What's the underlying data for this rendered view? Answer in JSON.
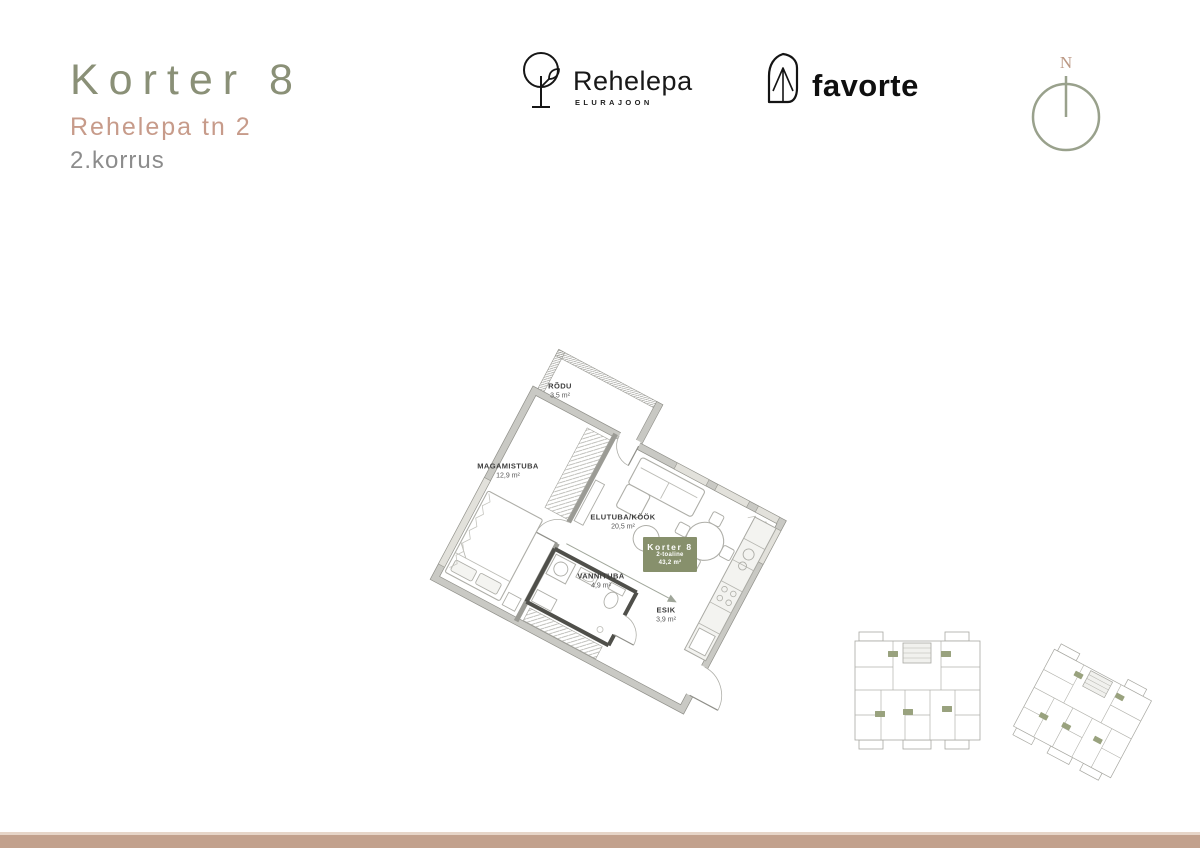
{
  "header": {
    "title": "Korter 8",
    "address": "Rehelepa tn 2",
    "floor": "2.korrus"
  },
  "branding": {
    "rehelepa": {
      "name": "Rehelepa",
      "tagline": "ELURAJOON"
    },
    "favorte": {
      "name": "favorte"
    }
  },
  "compass": {
    "label": "N"
  },
  "floor_plan": {
    "rooms": [
      {
        "name": "RÕDU",
        "area": "3,5 m²"
      },
      {
        "name": "MAGAMISTUBA",
        "area": "12,9 m²"
      },
      {
        "name": "ELUTUBA/KÖÖK",
        "area": "20,5 m²"
      },
      {
        "name": "VANNITUBA",
        "area": "4,9 m²"
      },
      {
        "name": "ESIK",
        "area": "3,9 m²"
      }
    ],
    "unit_badge": {
      "title": "Korter 8",
      "type": "2-toaline",
      "area": "43,2 m²"
    }
  },
  "colors": {
    "title_green": "#8a9077",
    "address_pink": "#c79b8a",
    "floor_gray": "#8c8c8c",
    "badge_green": "#87906c",
    "footer_tan": "#c2a18d",
    "compass_green": "#99a18c",
    "compass_n": "#bb9884",
    "highlight_sage": "#cdd3c3"
  }
}
